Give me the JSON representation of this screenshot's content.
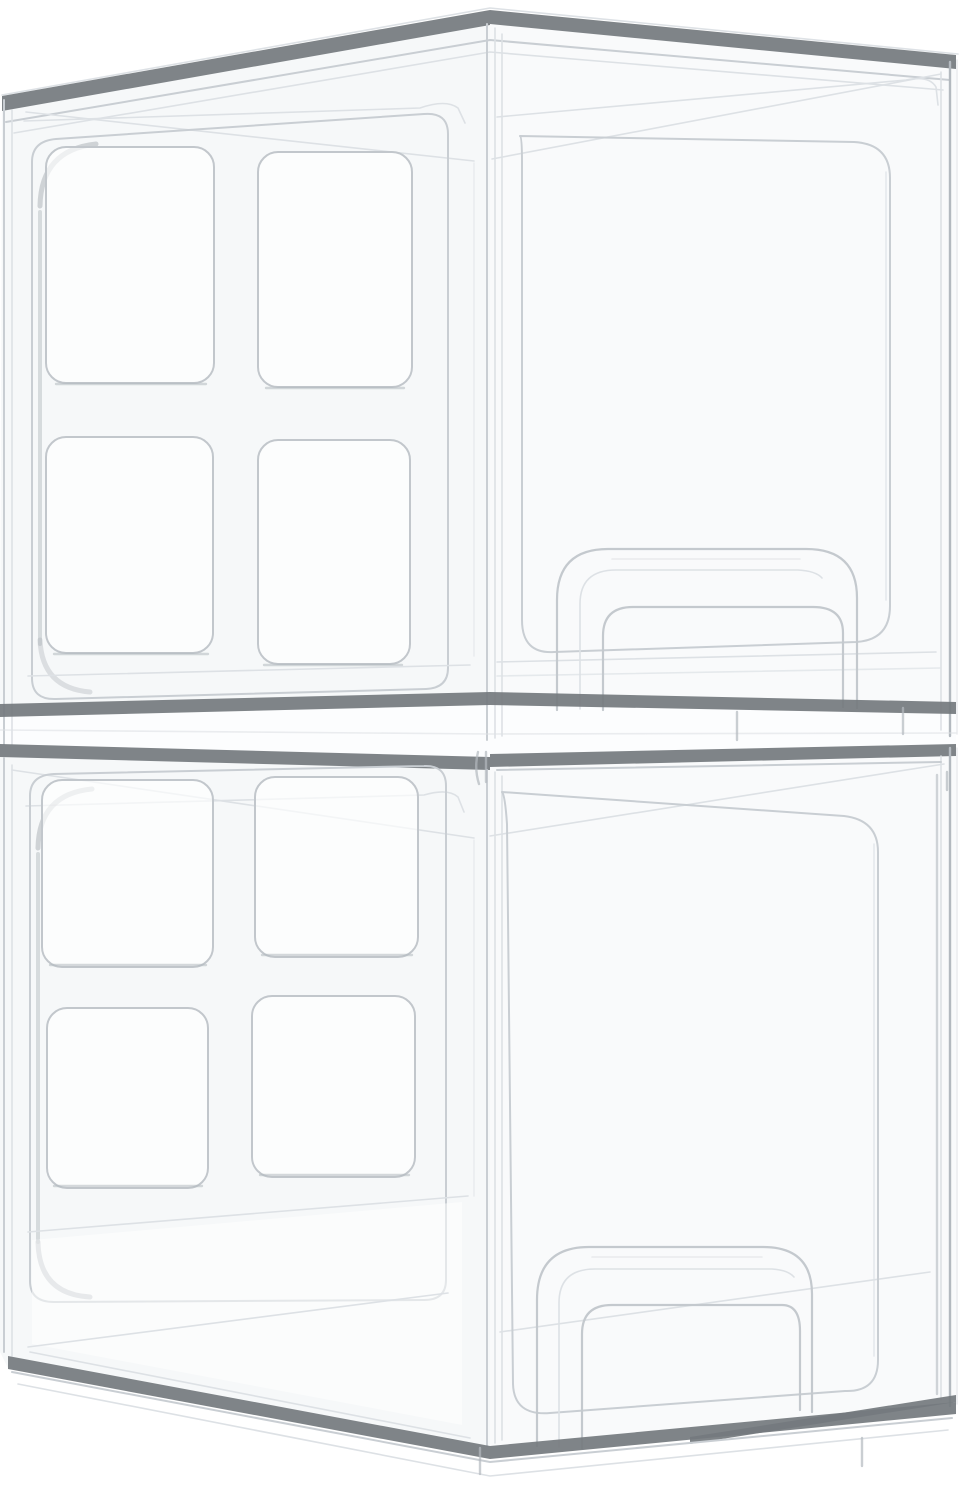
{
  "image": {
    "type": "product-photo",
    "subject": "Two clear stackable acrylic storage drawer organizers stacked vertically on a white background",
    "orientation": "three-quarter view from the front-left, slightly above",
    "material": "transparent clear plastic",
    "visible_text": [],
    "units": [
      {
        "id": "top-drawer-unit",
        "position": "top",
        "side_panel_cutouts": 4,
        "cutout_layout": "2x2 grid of rounded squares on left side panel",
        "front_handle": "arched pull handle cutout near bottom of drawer front",
        "drawer_front_inset": "large rounded-rectangle inset outline"
      },
      {
        "id": "bottom-drawer-unit",
        "position": "bottom",
        "side_panel_cutouts": 4,
        "cutout_layout": "2x2 grid of rounded squares on left side panel",
        "front_handle": "arched pull handle cutout near bottom of drawer front",
        "drawer_front_inset": "large rounded-rectangle inset outline"
      }
    ],
    "palette": {
      "background": "#ffffff",
      "edge_dark": "#74797e",
      "line_light": "#c9ced3",
      "line_faint": "#dde1e5",
      "line_med": "#b3b9bf",
      "accent_shadow": "#a8aeb4",
      "face_tint_left": "#f6f8f9",
      "face_tint_front": "#f9fafb",
      "cutout_fill": "#ffffff"
    }
  }
}
